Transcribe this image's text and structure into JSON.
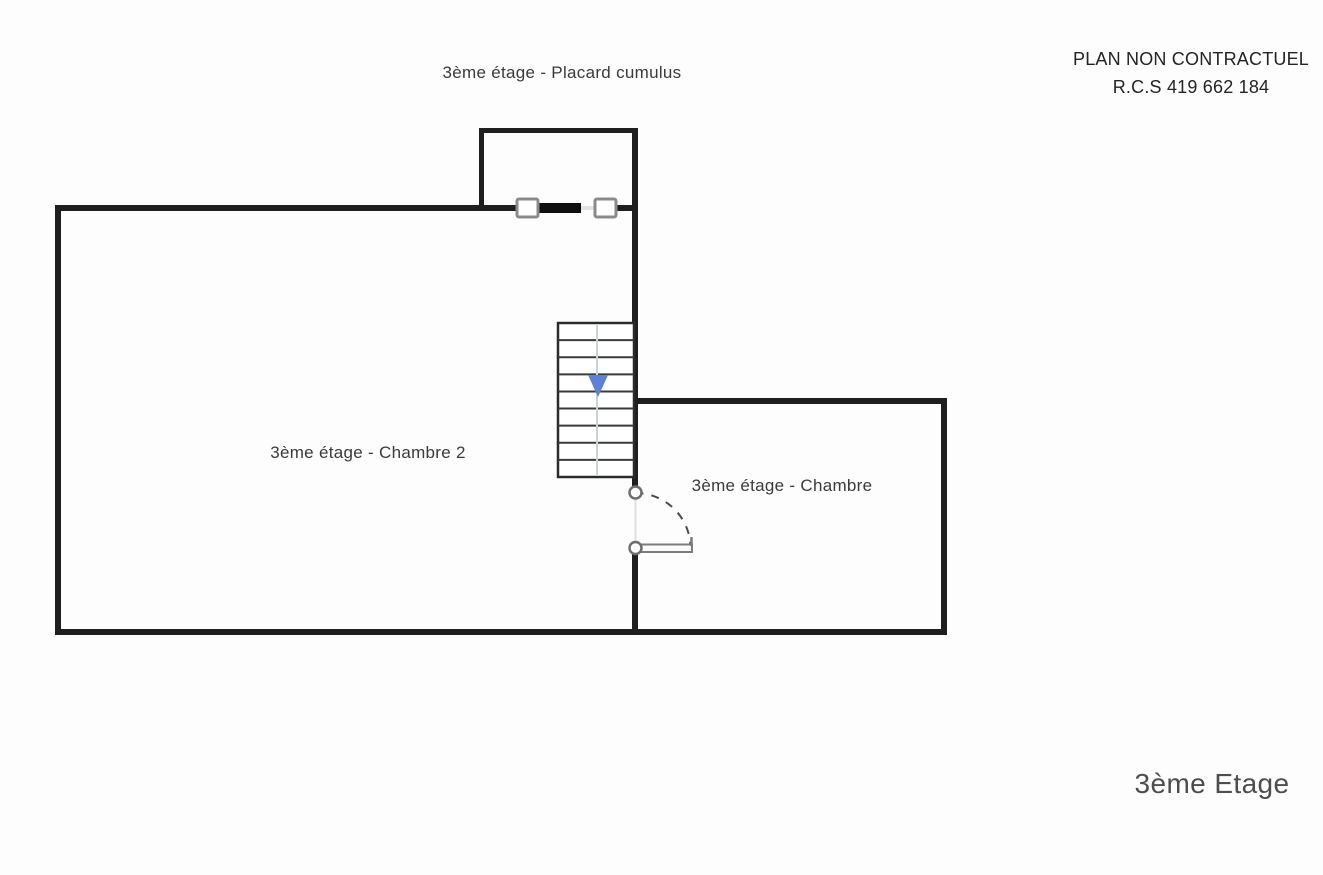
{
  "header": {
    "plan_title": "3ème étage - Placard cumulus",
    "disclaimer_line1": "PLAN NON CONTRACTUEL",
    "disclaimer_line2": "R.C.S 419 662 184"
  },
  "rooms": [
    {
      "label": "3ème étage - Chambre 2"
    },
    {
      "label": "3ème étage - Chambre"
    }
  ],
  "stairs": {
    "steps": 9,
    "direction": "down",
    "arrow_color": "#5b82d8"
  },
  "footer": {
    "floor_label": "3ème Etage"
  },
  "colors": {
    "wall": "#1f1f1f",
    "stair_outline": "#2b2b2b",
    "stair_tread": "#3a3a3a",
    "stair_centerline": "#ccd3db",
    "door_stroke": "#7d7d7d",
    "arc_stroke": "#4a4a4a"
  }
}
